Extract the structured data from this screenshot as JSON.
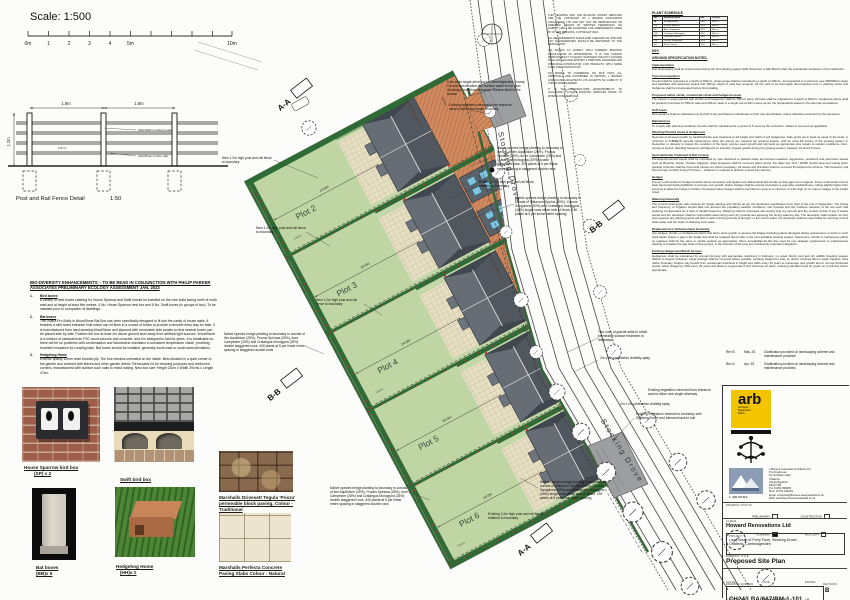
{
  "scale_bar": {
    "title": "Scale: 1:500",
    "ticks": [
      "0m",
      "1",
      "2",
      "3",
      "4",
      "5m",
      "10m"
    ]
  },
  "fence_detail": {
    "span1": "1.8m",
    "span2": "1.8m",
    "height": "1.2m",
    "rail_gap": "0.27m",
    "posts_label": "100x100mm timber posts",
    "rails_label": "100x25mm timber rails",
    "caption": "Post and Rail Fence Detail",
    "scale": "1:50"
  },
  "biodiversity": {
    "heading": "BIO-DIVERSITY ENHANCEMENTS: - TO BE READ IN CONJUNCTION WITH PHILIP PARKER ASSOCIATES PRELIMINARY ECOLOGY ASSESSMENT JAN. 2023",
    "items": [
      {
        "num": "1.",
        "title": "Bird boxes",
        "body": "A variety of nest boxes catering for House Sparrow and Swift should be installed on the new build facing north of north east and at height at least five metres. 4 No. House Sparrow nest box and 8 No. Swift boxes (in groups of two). To be installed prior to occupation of dwellings."
      },
      {
        "num": "2.",
        "title": "Bat boxes",
        "body": "The Vivara Pro Build-in WoodStone Bat Box has been specifically designed to fit into the cavity of house walls. It features a slim sized entrance hole which can sit flush in a course of bricks to provide a discreet entry way for bats. It is manufactured from hard-wearing WoodStone and plywood with removable side panels so that several boxes can be placed side by side. Position the box at least 2m above ground level away from artificial light sources. WoodStone is a mixture of sawdust from FSC wood sources and concrete, and it is designed to last for years. It is breathable so there will be no problems with condensation and Woodstone maintains a consistent temperature inside, providing excellent insulation for roosting bats. Bat boxes should be installed, generally south-east or south-west elevations."
      },
      {
        "num": "3.",
        "title": "Hedgehog Home",
        "body": "Exterior quality 12mm resin bonded ply. The box remains untreated on the inside. Best situated in a quiet corner of the garden and covered with leaves and other garden debris. Removable lid for cleaning purposes and reinforced corners, manufactured with surface such nails to resist rusting. Nest box size: Height 23cm x Width 39cms x Length 47cm"
      }
    ]
  },
  "photos": {
    "sparrow_cap1": "House Sparrow bird box",
    "sparrow_cap2": "(SP) x 2",
    "swift_cap": "Swift bird box",
    "bat_cap1": "Bat boxes",
    "bat_cap2": "(BB)x 5",
    "hog_cap1": "Hedgehog Home",
    "hog_cap2": "(HH)x 1",
    "tegula_cap": "Marshalls Drivesett Tegula 'Priora' permeable block paving, Colour - Traditional",
    "perfecta_cap": "Marshalls Perfecta Concrete Paving Slabs Colour - Natural"
  },
  "plan": {
    "road_label": "Stocking Drove",
    "plots": [
      "Plot 2",
      "Plot 3",
      "Plot 4",
      "Plot 5",
      "Plot 6"
    ],
    "grass_label": "Grass",
    "paving_label": "Permeable block paving",
    "section_aa": "A-A",
    "section_bb": "B-B",
    "dims": {
      "plot_width": "14.0m",
      "drive1": "19.8m",
      "drive2": "15.7m",
      "drive3": "15.3m"
    },
    "annotations": [
      "New 1.2m high post and rail fence to boundary",
      "New 1.2m high post and rail fence to boundary",
      "New 1.2m high post and rail fence to boundary",
      "Native species hedge planting to boundary to consist of Ilex Aquifolium (25%), Prunus Spinosa (25%), Acer Campestre (25%) and Crataegus Monogyna (25%) double staggered rows. 440 plants at 5 per linear metre spacing in staggered double rows",
      "Native species hedge planting to boundary to consist of Ilex Aquifolium (25%), Prunus Spinosa (25%), Acer Campestre (25%) and Crataegus Monogyna (25%) double staggered rows. 440 plants at 5 per linear metre spacing in staggered double rows",
      "Native species hedge planting to boundary to consist of Ilex Aquifolium (25%), Prunus Spinosa (25%), Ac er Campestre (25%) and Crataegus Monogyna (25%) double staggered rows. 300 plants at 5 per linear metre spacing in staggered double rows",
      "Existing 1.2m high post and rail fence retained to boundary",
      "Native species hedge planting to boundary to consist of Viburnum Opulus (30%), Cornus Sanguinea (30%) and Crataegus monogyna (40%) single rows either side of fence. 150 plants at 5 per linear metre spacing",
      "3.6m wide single driveway to Cambridgeshire County Council specification. No surface water to run onto Stocking Drove from entrance. Surface finish to be tarmac.",
      "Existing vegetation removed from entrance area to allow new single driveway",
      "2m x 2m pedestrian visibility splay",
      "Existing vegetation removed from entrance area to allow new single driveway",
      "2m x 2m pedestrian visibility splay",
      "Existing vegetation retained to boundary with Stocking Drove and trimmed back to suit",
      "Existing 1.2m high post and rail fence retained to boundary",
      "Native species hedge planting to boundary to consist of Viburnum Opulus (30%), Cornus Sanguinea (30%) and Crataegus monogyna (40%) single rows either side of fence. 150 plants at 5 per linear metre spacing",
      "Two rows of granite setts to retain permeable surface treatment to driveways"
    ]
  },
  "disclaimer": [
    "THIS DRAWING AND THE BUILDING WORKS DEPICTED ARE THE COPYRIGHT OF L BEVENS ASSOCIATES ARCHITECTS LTD AND MAY NOT BE REPRODUCED OR AMENDED EXCEPT BY WRITTEN PERMISSION. NO LIABILITY WILL BE ACCEPTED FOR AMENDMENTS MADE BY OTHER PERSONS. COPYRIGHT 2024.",
    "ALL MEASUREMENTS SHOULD BE CHECKED ON SITE AND ANY DISCREPANCIES SHOULD BE REPORTED TO THE DESIGNATOR.",
    "ALL WORKS TO COMPLY WITH CURRENT BUILDING REGULATIONS AS APPROPRIATE. IT IS THE CLIENTS RESPONSIBILITY TO ELECT WHETHER THE DUTY HOLDER ROLE APPLIES AND APPOINT A PRINCIPAL DESIGNER AND PRINCIPAL CONTRACTOR FOR PROJECTS WITH MORE THAN ONE CONTRACTOR.",
    "NO WORKS TO COMMENCE ON SITE UNTIL ALL APPROVALS ARE CONFIRMED IN WRITING. L BEVENS ASSOCIATES ARCHITECTS LTD ACCEPTS NO LIABILITY IF THIS IS DISREGARDED.",
    "IT IS THE CONTRACTORS RESPONSIBILITY TO ACCURATELY LOCATE EXISTING SERVICES PRIOR TO WORKS COMMENCING."
  ],
  "plant_schedule": {
    "title": "PLANT SCHEDULE",
    "headers": [
      "No.",
      "Botanical Name",
      "Mix",
      "Centres"
    ],
    "rows": [
      [
        "IA",
        "Ilex Aquifolium",
        "25%",
        "5/lin m"
      ],
      [
        "PS",
        "Prunus Spinosa",
        "25%",
        "5/lin m"
      ],
      [
        "AC",
        "Acer Campestre",
        "25%",
        "5/lin m"
      ],
      [
        "CM",
        "Crataegus Monogyna",
        "25%",
        "5/lin m"
      ],
      [
        "VO",
        "Viburnum Opulus",
        "30%",
        "5/lin m"
      ],
      [
        "CS",
        "Cornus Sanguinea",
        "30%",
        "5/lin m"
      ],
      [
        "RC",
        "Rosa Canina",
        "10%",
        "5/lin m"
      ]
    ]
  },
  "notes": {
    "key_title": "KEY",
    "title": "GROUND SPECIFICATION NOTES.",
    "sections": [
      {
        "h": "Implementation",
        "b": "Soft landscaping shall be implemented during the first planting season (Mid November to Mid March) after the substantial completion of the hardworks."
      },
      {
        "h": "Topsoil preparation",
        "b": "Ground shall be prepared to a depth of 300mm. Grass areas shall be rotovated to a depth of 100mm, decompacted to a minimum over 450/600mm deep and backfilled with approved topsoil and 150mm depth of peat free compost. All the soils to be thoroughly decompacted prior to planting works and hedgerow shall be incorporated before final grading."
      },
      {
        "h": "Proposed native shrub, ornamental shrub and hedgerow areas",
        "b": "The topsoil in areas planted with shrubs and hedgerows shall be 350mm deep. All beds shall be cultivated to a depth of 300mm. Hedgerow plants shall be planted in trenches of 750mm wide and 300mm deep in a single row at 5/lin metres as per the preparations stated on the site plan annotations."
      },
      {
        "h": "Soft Areas",
        "b": "New gardens shall be cultivated only and left to the purchasers to landscape to their own specification unless otherwise instructed by the developer."
      },
      {
        "h": "Maintenance",
        "b": "To comply with planning conditions the site shall be maintained for a period of 5 years by the contractor, matted or removed as applicable."
      },
      {
        "h": "Weeding Planted Areas & Hedgerows",
        "b": "Removal of all weed growth by hand/herbicide spot treatment to full height and width of soil hedgerows. Take grubs out in beds as usual 'in the beds'. A minimum of THREE(3) general maintenance visits per annum are required per growing season, with an extra full survey of the growing season in December or January to inspect the condition of the beds, remove weed growth and tidy beds as appropriate plus repairs to sodden conditions. Over-turning of topsoil. Weeding frequency will depend on intensity of weed growth during the growing season, between 16 and 5-6 times."
      },
      {
        "h": "Spot Herbicide Treatment & Rat Control",
        "b": "Persistent/perennial weeds shall be controlled by spot treatment to planted areas and fenced meadows. Aggressive, persistent and pernicious weeds such as Bramble, Docks, Thistles, Ragwort, Giant Hogweed shall be removed where found. For latter text 12.5 / 2009F control area and setting down planting schemes shall be timed and carried out where necessary. All weeds and brambles shall be removed throughout the scheme. This frequency will then be kept monthly during 5-6 times -- whatever is required to achieve a weed free scheme."
      },
      {
        "h": "Hedges",
        "b": "Top-up mulch levels for hedge trenches where necessary and replace any failed plants like-for-like so that gaps do not appear. Prune ornamental Cornus back hard each February/March to promote new growth. Native hedges shall be pruned once/twice a year after establishment, cutting slightly higher than previous to allow the hedge to thicken. Proposed native hedges shall be permitted to grow to a minimum of 1.8m high (2.1m max) in stages to the height noted."
      },
      {
        "h": "Watering Generally",
        "b": "The Council shall apply safe volumes for hedge planting and shrubs as per the landscape specification from April to the end of September. The timing and frequency of irrigation should take into account the prevailing weather conditions, rain forecast and the moisture retention of the soil such that watering compensates for a lack of rainfall frequency. Watering shall be increased also during long dry periods and the contact arrival of say 5 weeks period and the developer shall be responsible determining such dry periods and agreeing the timing watering slot. The developer shall replace not hurt own expense any planting period will plan to lack of during periods of drought, or the cost to water, the developer shall be responsible for sourcing council class water and the costs of obtaining such water."
      },
      {
        "h": "Replacement or Enhancement Generally",
        "b": "Any hedges, shrubs, or herbaceous plants that fail to show growth or develop full foliage (including plants damaged during maintenance or work) or such plant failure leaves a gap in the hedge line shall be replaced like-for-like in the next available planting season. Specimens, shrubs or herbaceous plants so replaced shall be the same or similar position as appropriate. Since annuals/like-for-like this need be one strategic replacement or enhancement planting to broaden the age class of tree groups, in the interests of the long term biodiversity important integration."
      },
      {
        "h": "Existing Hedgerows/Shrub Groups",
        "b": "Hedgerows shall be maintained by annual trimming with appropriate machinery in February, no noted clients yard and dry wildlife breeding season (March to August inclusive). Large arisings shall be removed where possible, be likely hedged be cold, by doctor mounted flail on weak chippers. New native boundary hedges may benefit from occasional reductions in height and width every 20 years to encourage new growth and to remove thickened woody native hedges by 20% every 20 years and allow to re-generate if size becomes an issue, retaining standard trees be grown on to full size where appropriate."
      }
    ]
  },
  "revisions": [
    {
      "rev": "Rev B",
      "date": "May. 25",
      "desc": "Clarification provided on landscaping scheme and maintenance provided."
    },
    {
      "rev": "Rev A",
      "date": "Apr. 25",
      "desc": "Clarification provided on landscaping scheme and maintenance provided."
    }
  ],
  "title_block": {
    "arb_text": "arb",
    "arb_sub1": "Architects",
    "arb_sub2": "Registration",
    "arb_sub3": "Board",
    "firm_name": "L BEVENS",
    "address": [
      "L Bevens Associates Architects Ltd",
      "The Doghouse",
      "10 Cricketers Way",
      "Chatteris",
      "Cambridgeshire",
      "PE16 6JB",
      "Tel: 01354 696965",
      "Mob: 07754 342219",
      "Email: enquiries@lbevens-associatesltd.co.uk",
      "Web: www.lbevens-associatesltd.co.uk"
    ],
    "status_label": "DRAWING STATUS",
    "status_preliminary": "PRELIMINARY",
    "status_planning": "PLANNING",
    "status_construction": "CONSTRUCTION",
    "status_filecopy": "FILE COPY",
    "client_label": "CLIENT",
    "client": "Howard Renovations Ltd",
    "project_label": "PROJECT",
    "project_line1": "Land South of Ferry Farm, Stocking Drove,",
    "project_line2": "Chatteris, Cambridgeshire.",
    "title_label": "DRAWING TITLE",
    "drawing_title": "Proposed Site Plan",
    "scale_label": "SCALE",
    "scale": "1:500 @ A2",
    "date_label": "DATE",
    "date": "September 2024",
    "drawn_label": "DRAWN",
    "drawn": "LB",
    "checked_label": "CHECKED",
    "checked": "",
    "number_label": "DRAWING NUMBER",
    "number": "CH24/LBA/667/RM-1-101",
    "revision_label": "REVISION",
    "revision": "B"
  }
}
